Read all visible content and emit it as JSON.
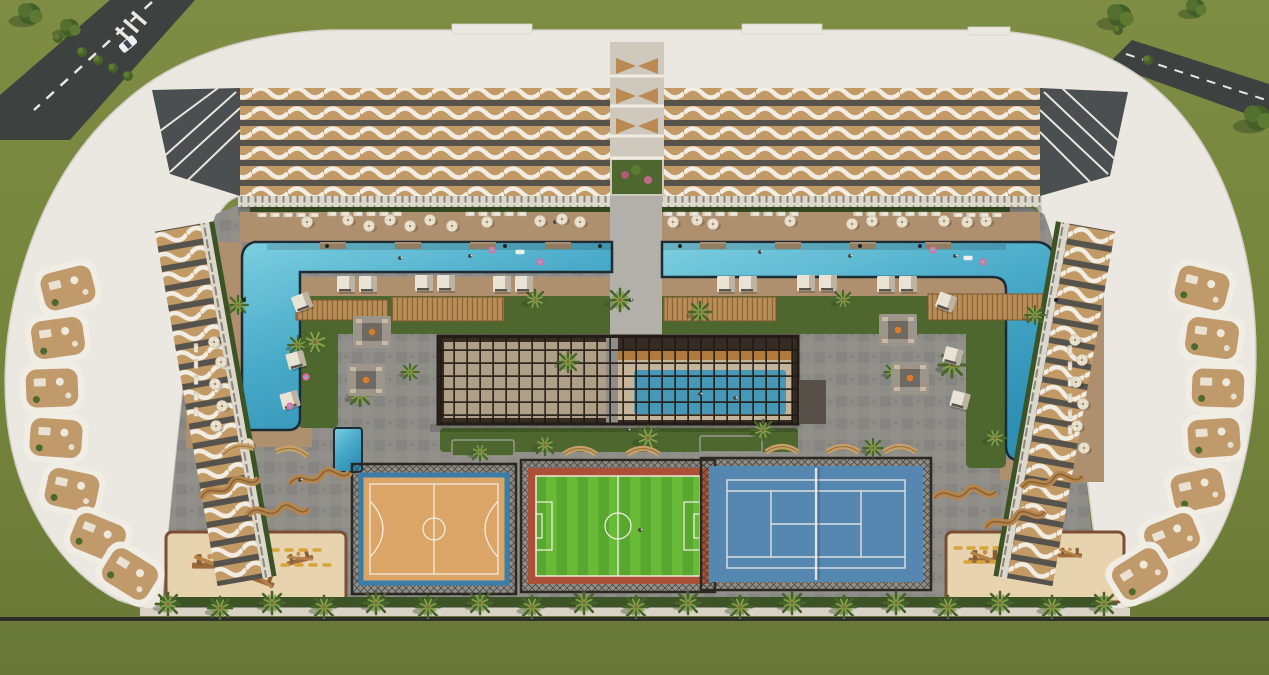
{
  "scene": {
    "title": "Aerial 3D render of a U-shaped residential resort complex with two L-shaped pools, a louvered amenity pavilion with indoor pool, basketball, football and tennis courts, playgrounds and landscaped courtyard",
    "type": "architectural-render",
    "features": [
      "left L-shaped outdoor pool",
      "right L-shaped outdoor pool",
      "indoor pool under louvered pergola",
      "basketball court",
      "football pitch",
      "tennis court",
      "kids playground left",
      "kids playground right",
      "fire-pit lounges",
      "cabanas",
      "palm promenade",
      "perimeter road top-left",
      "perimeter road top-right"
    ]
  },
  "colors": {
    "grass": "#76853c",
    "grassDark": "#67762f",
    "road": "#3d4140",
    "roadLine": "#e9e7df",
    "roofWhite": "#ebe8e1",
    "roofEdge": "#d2cec5",
    "facadeTan": "#c29a66",
    "facadeDark": "#56534d",
    "facadeWhite": "#f2ede3",
    "paving": "#8e8d88",
    "pavingDark": "#7e7d78",
    "pathLight": "#b2b0a8",
    "colonnade": "#ddd8cc",
    "deck": "#ae8f6e",
    "lawn": "#4e672e",
    "hedge": "#3c5425",
    "poolBlue": "#55b7d2",
    "poolDeep": "#2e8fb4",
    "poolEdge": "#1c2b34",
    "pergolaDark": "#362c23",
    "pergolaFloor": "#c6b499",
    "indoorPool": "#4798b6",
    "pergolaWood": "#b07a3f",
    "basketballSurface": "#daa566",
    "basketballBorder": "#3a7da6",
    "courtLine": "#f4f1e8",
    "soccerGreen": "#58a82f",
    "soccerGreenLight": "#69bb37",
    "soccerBorder": "#ab4f36",
    "tennisBlue": "#5687b0",
    "fenceDark": "#2b2723",
    "sand": "#e7d4af",
    "sandEdge": "#7a4f33",
    "woodBench": "#b5854e",
    "woodPlay": "#9c6a3b",
    "umbrella": "#ece4d1",
    "cabana": "#e9e3d6",
    "curb": "#d8d2c4",
    "equipYellow": "#d8a43a",
    "floatPink": "#e06ea0"
  },
  "scatter": [
    {
      "sym": "#sym-tree",
      "layer": "layer-trees",
      "name": "tree",
      "items": [
        [
          30,
          14,
          0,
          1.2
        ],
        [
          70,
          28,
          0,
          1
        ],
        [
          1120,
          16,
          0,
          1.3
        ],
        [
          1258,
          118,
          0,
          1.4
        ],
        [
          1196,
          8,
          0,
          1
        ]
      ]
    },
    {
      "sym": "#sym-bush",
      "layer": "layer-trees",
      "name": "bush",
      "items": [
        [
          82,
          52
        ],
        [
          98,
          60
        ],
        [
          113,
          68
        ],
        [
          128,
          76
        ],
        [
          58,
          38
        ],
        [
          1148,
          60
        ],
        [
          1118,
          30
        ]
      ]
    },
    {
      "sym": "#sym-palm",
      "layer": "layer-palms",
      "name": "palm-tree",
      "items": [
        [
          168,
          604,
          0,
          1.1
        ],
        [
          220,
          608,
          0,
          1.1
        ],
        [
          272,
          603,
          0,
          1.1
        ],
        [
          324,
          607,
          0,
          1.1
        ],
        [
          376,
          603,
          0,
          1.1
        ],
        [
          428,
          607,
          0,
          1.1
        ],
        [
          480,
          603,
          0,
          1.1
        ],
        [
          532,
          607,
          0,
          1.1
        ],
        [
          584,
          603,
          0,
          1.1
        ],
        [
          636,
          607,
          0,
          1.1
        ],
        [
          688,
          603,
          0,
          1.1
        ],
        [
          740,
          607,
          0,
          1.1
        ],
        [
          792,
          603,
          0,
          1.1
        ],
        [
          844,
          607,
          0,
          1.1
        ],
        [
          896,
          603,
          0,
          1.1
        ],
        [
          948,
          607,
          0,
          1.1
        ],
        [
          1000,
          603,
          0,
          1.1
        ],
        [
          1052,
          607,
          0,
          1.1
        ],
        [
          1104,
          604,
          0,
          1.1
        ],
        [
          315,
          342,
          0,
          1.3
        ],
        [
          360,
          395,
          0,
          1.1
        ],
        [
          238,
          305,
          0,
          0.9
        ],
        [
          535,
          300,
          0,
          1.0
        ],
        [
          568,
          362,
          0,
          1.0
        ],
        [
          620,
          300,
          0,
          1.1
        ],
        [
          648,
          438,
          0,
          1.2
        ],
        [
          700,
          312,
          0,
          1.0
        ],
        [
          763,
          430,
          0,
          1.0
        ],
        [
          843,
          300,
          0,
          0.9
        ],
        [
          952,
          365,
          0,
          1.2
        ],
        [
          995,
          438,
          0,
          1.0
        ],
        [
          545,
          445,
          0,
          1.0
        ],
        [
          480,
          452,
          0,
          0.9
        ],
        [
          873,
          448,
          0,
          0.9
        ],
        [
          1035,
          315,
          0,
          0.9
        ],
        [
          298,
          345,
          0,
          0.9
        ],
        [
          410,
          372,
          0,
          0.8
        ],
        [
          893,
          372,
          0,
          0.8
        ]
      ]
    },
    {
      "sym": "#sym-umbrella",
      "layer": "layer-furniture",
      "name": "parasol",
      "items": [
        [
          307,
          222
        ],
        [
          348,
          220
        ],
        [
          369,
          226
        ],
        [
          390,
          220
        ],
        [
          410,
          226
        ],
        [
          430,
          220
        ],
        [
          452,
          226
        ],
        [
          487,
          222
        ],
        [
          540,
          221
        ],
        [
          562,
          219
        ],
        [
          580,
          222
        ],
        [
          673,
          222
        ],
        [
          697,
          220
        ],
        [
          713,
          224
        ],
        [
          790,
          221
        ],
        [
          852,
          224
        ],
        [
          872,
          221
        ],
        [
          902,
          222
        ],
        [
          944,
          221
        ],
        [
          967,
          222
        ],
        [
          986,
          221
        ],
        [
          214,
          342
        ],
        [
          221,
          362
        ],
        [
          215,
          384
        ],
        [
          222,
          406
        ],
        [
          216,
          426
        ],
        [
          1075,
          340
        ],
        [
          1082,
          360
        ],
        [
          1076,
          382
        ],
        [
          1083,
          404
        ],
        [
          1077,
          426
        ],
        [
          1084,
          448
        ],
        [
          248,
          444
        ]
      ]
    },
    {
      "sym": "#sym-lounger",
      "layer": "layer-furniture",
      "name": "sun-lounger",
      "items": [
        [
          262,
          215,
          0,
          1,
          5,
          13,
          0
        ],
        [
          332,
          214,
          0,
          1,
          6,
          13,
          0
        ],
        [
          470,
          214,
          0,
          1,
          5,
          13,
          0
        ],
        [
          668,
          214,
          0,
          1,
          6,
          13,
          0
        ],
        [
          755,
          214,
          0,
          1,
          4,
          13,
          0
        ],
        [
          858,
          214,
          0,
          1,
          7,
          13,
          0
        ],
        [
          958,
          215,
          0,
          1,
          4,
          13,
          0
        ],
        [
          196,
          348,
          90,
          1,
          5,
          0,
          16
        ],
        [
          1070,
          350,
          90,
          1,
          6,
          0,
          16
        ]
      ]
    },
    {
      "sym": "#sym-cabana",
      "layer": "layer-furniture",
      "name": "cabana",
      "items": [
        [
          346,
          284
        ],
        [
          368,
          284
        ],
        [
          424,
          283
        ],
        [
          446,
          283
        ],
        [
          502,
          284
        ],
        [
          524,
          284
        ],
        [
          726,
          284
        ],
        [
          748,
          284
        ],
        [
          806,
          283
        ],
        [
          828,
          283
        ],
        [
          886,
          284
        ],
        [
          908,
          284
        ],
        [
          302,
          302,
          -20
        ],
        [
          296,
          360,
          -15
        ],
        [
          290,
          400,
          -15
        ],
        [
          946,
          302,
          20
        ],
        [
          953,
          356,
          15
        ],
        [
          960,
          400,
          15
        ]
      ]
    },
    {
      "sym": "#sym-terrace",
      "layer": "layer-terraces",
      "name": "roof-terrace",
      "items": [
        [
          68,
          288,
          -14
        ],
        [
          58,
          338,
          -8
        ],
        [
          52,
          388,
          -2
        ],
        [
          56,
          438,
          4
        ],
        [
          72,
          490,
          12
        ],
        [
          98,
          537,
          22
        ],
        [
          130,
          574,
          32
        ],
        [
          1202,
          288,
          14
        ],
        [
          1212,
          338,
          8
        ],
        [
          1218,
          388,
          2
        ],
        [
          1214,
          438,
          -4
        ],
        [
          1198,
          490,
          -12
        ],
        [
          1172,
          537,
          -22
        ],
        [
          1140,
          574,
          -32
        ]
      ]
    },
    {
      "sym": "#sym-arcbench",
      "layer": "layer-furniture",
      "name": "curved-bench",
      "items": [
        [
          238,
          450,
          -12
        ],
        [
          292,
          452,
          8
        ],
        [
          580,
          452,
          0
        ],
        [
          643,
          452,
          0
        ],
        [
          782,
          450,
          0
        ],
        [
          843,
          450,
          0
        ],
        [
          900,
          450,
          0
        ]
      ]
    },
    {
      "sym": "#sym-wavy",
      "layer": "layer-furniture",
      "name": "sculptural-wood-bench",
      "items": [
        [
          230,
          488,
          -8
        ],
        [
          278,
          512,
          5
        ],
        [
          320,
          478,
          0
        ],
        [
          965,
          495,
          5
        ],
        [
          1015,
          520,
          -5
        ],
        [
          1052,
          482,
          0
        ]
      ]
    },
    {
      "sym": "#sym-firepit",
      "layer": "layer-furniture",
      "name": "fire-pit-lounge",
      "items": [
        [
          372,
          332
        ],
        [
          366,
          380
        ],
        [
          898,
          330
        ],
        [
          910,
          378
        ]
      ]
    },
    {
      "sym": "#sym-play",
      "layer": "layer-play",
      "name": "play-structure",
      "items": [
        [
          210,
          565,
          0,
          1.2
        ],
        [
          260,
          580,
          20,
          1
        ],
        [
          300,
          560,
          -15,
          0.9
        ],
        [
          985,
          560,
          0,
          1.1
        ],
        [
          1035,
          575,
          15,
          0.9
        ],
        [
          1070,
          555,
          0,
          0.8
        ]
      ]
    },
    {
      "sym": "#sym-equip",
      "layer": "layer-play",
      "name": "outdoor-gym-equipment",
      "items": [
        [
          275,
          550,
          0,
          1,
          4,
          14,
          0
        ],
        [
          285,
          565,
          0,
          1,
          4,
          14,
          0
        ],
        [
          958,
          548,
          0,
          1,
          4,
          13,
          0
        ],
        [
          968,
          562,
          0,
          1,
          4,
          13,
          0
        ]
      ]
    },
    {
      "sym": "#sym-person",
      "layer": "layer-people",
      "name": "person",
      "items": [
        [
          400,
          258
        ],
        [
          470,
          256
        ],
        [
          760,
          252
        ],
        [
          850,
          256
        ],
        [
          700,
          394
        ],
        [
          735,
          398
        ],
        [
          630,
          300
        ],
        [
          628,
          430
        ],
        [
          300,
          480
        ],
        [
          555,
          222
        ],
        [
          955,
          256
        ],
        [
          640,
          530
        ]
      ]
    },
    {
      "sym": "#sym-floatpink",
      "layer": "layer-people",
      "name": "pool-float-pink",
      "items": [
        [
          306,
          377
        ],
        [
          290,
          406
        ],
        [
          492,
          250
        ],
        [
          540,
          262
        ],
        [
          933,
          250
        ],
        [
          983,
          262
        ]
      ]
    },
    {
      "sym": "#sym-floatwhite",
      "layer": "layer-people",
      "name": "pool-float-white",
      "items": [
        [
          968,
          258
        ],
        [
          520,
          252
        ]
      ]
    },
    {
      "sym": "#sym-dotdark",
      "layer": "layer-people",
      "name": "pool-ladder",
      "items": [
        [
          327,
          246
        ],
        [
          505,
          246
        ],
        [
          600,
          246
        ],
        [
          680,
          246
        ],
        [
          860,
          246
        ],
        [
          920,
          246
        ],
        [
          244,
          300
        ],
        [
          1056,
          300
        ]
      ]
    }
  ]
}
